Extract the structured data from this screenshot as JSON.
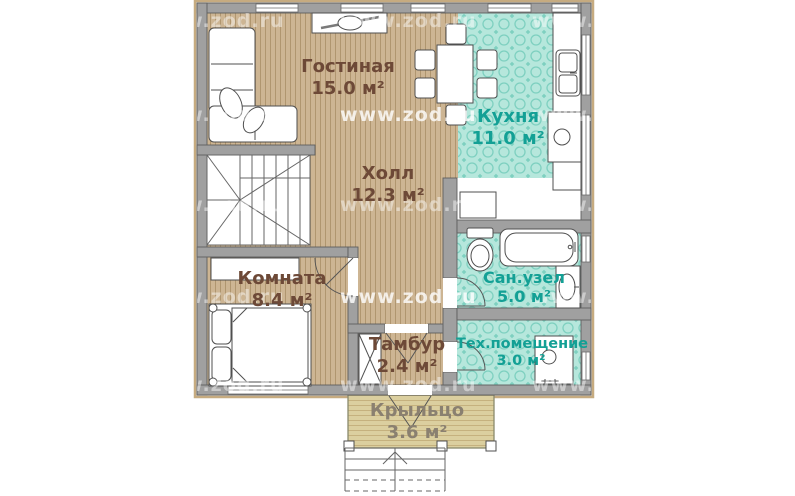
{
  "watermark": {
    "text": "www.zod.ru"
  },
  "rooms": [
    {
      "id": "living",
      "name": "Гостиная",
      "area": "15.0 м²"
    },
    {
      "id": "kitchen",
      "name": "Кухня",
      "area": "11.0 м²"
    },
    {
      "id": "hall",
      "name": "Холл",
      "area": "12.3 м²"
    },
    {
      "id": "bedroom",
      "name": "Комната",
      "area": "8.4 м²"
    },
    {
      "id": "bathroom",
      "name": "Сан.узел",
      "area": "5.0 м²"
    },
    {
      "id": "vestibule",
      "name": "Тамбур",
      "area": "2.4 м²"
    },
    {
      "id": "tech",
      "name": "Тех.помещение",
      "area": "3.0 м²"
    },
    {
      "id": "porch",
      "name": "Крыльцо",
      "area": "3.6 м²"
    }
  ],
  "colors": {
    "label_brown": "#6d4937",
    "label_teal": "#13a095",
    "label_porch": "#8a8070",
    "wall_gray": "#a0a0a0",
    "wood_floor": "#cdb593",
    "tile_teal": "#b6e7dc",
    "porch_floor": "#dbcf9f",
    "watermark": "#ffffff"
  },
  "icons": [
    "sofa-icon",
    "fireplace-icon",
    "dining-table-icon",
    "chair-icon",
    "stairs-icon",
    "kitchen-counter-icon",
    "sink-icon",
    "cooktop-icon",
    "cabinet-icon",
    "toilet-icon",
    "bathtub-icon",
    "washbasin-icon",
    "boiler-icon",
    "wardrobe-icon",
    "bed-icon",
    "porch-steps-icon",
    "door-swing-icon",
    "window-icon"
  ]
}
